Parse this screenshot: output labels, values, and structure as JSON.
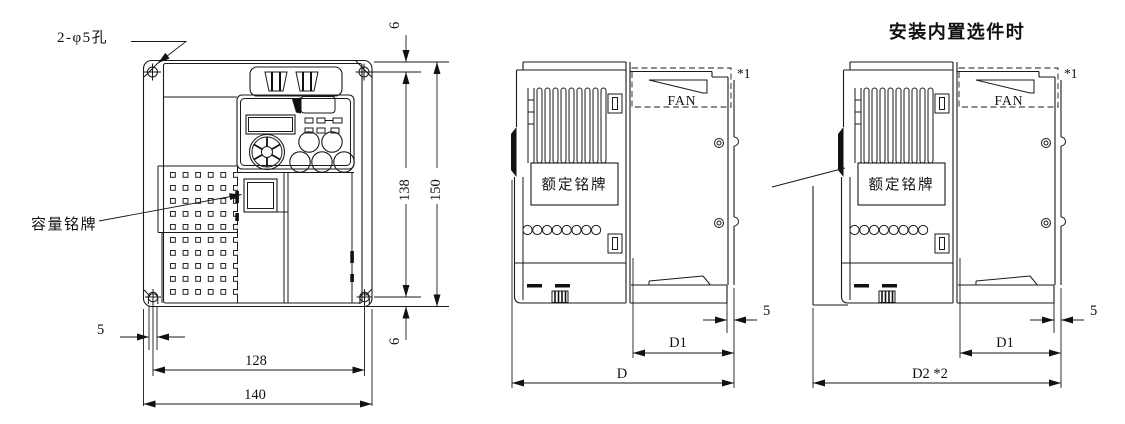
{
  "front_view": {
    "hole_callout": "2-φ5孔",
    "capacity_nameplate": "容量铭牌",
    "dims": {
      "top_offset": "6",
      "hole_pitch_v": "138",
      "height": "150",
      "bottom_offset": "6",
      "slot_width": "5",
      "hole_pitch_h": "128",
      "width": "140"
    }
  },
  "side_view": {
    "fan": "FAN",
    "footnote": "*1",
    "rated_nameplate": "额定铭牌",
    "dims": {
      "rear_ledge": "5",
      "d1": "D1",
      "depth": "D"
    }
  },
  "option_view": {
    "heading": "安装内置选件时",
    "fan": "FAN",
    "footnote": "*1",
    "rated_nameplate": "额定铭牌",
    "dims": {
      "rear_ledge": "5",
      "d1": "D1",
      "depth": "D2 *2"
    }
  }
}
